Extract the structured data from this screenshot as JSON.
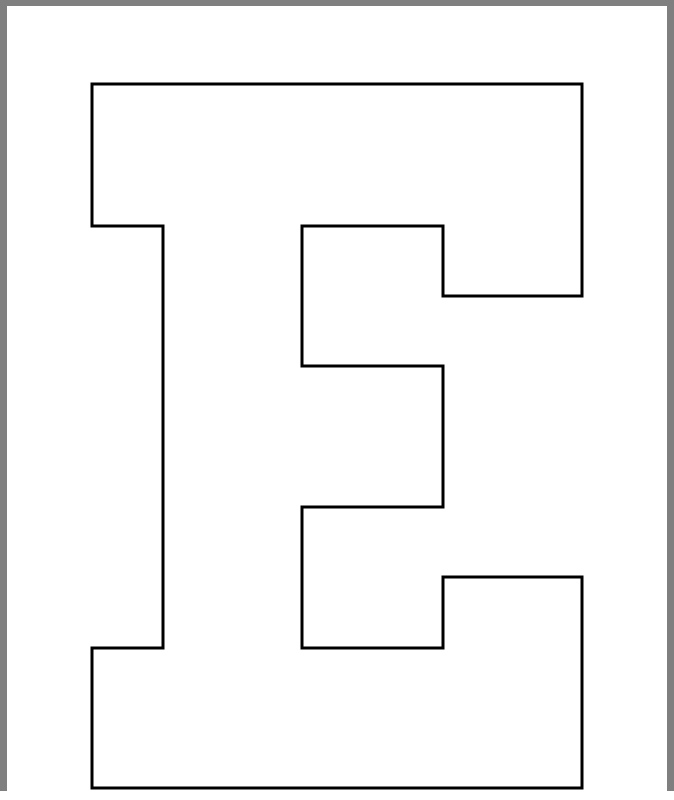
{
  "page": {
    "background_color": "#ffffff",
    "frame_color": "#7f7f7f"
  },
  "letter": {
    "character": "E",
    "outline_color": "#000000",
    "fill_color": "#ffffff",
    "stroke_width": 3,
    "outline_points": [
      [
        92,
        84
      ],
      [
        582,
        84
      ],
      [
        582,
        296
      ],
      [
        443,
        296
      ],
      [
        443,
        226
      ],
      [
        302,
        226
      ],
      [
        302,
        366
      ],
      [
        443,
        366
      ],
      [
        443,
        507
      ],
      [
        302,
        507
      ],
      [
        302,
        648
      ],
      [
        443,
        648
      ],
      [
        443,
        577
      ],
      [
        582,
        577
      ],
      [
        582,
        788
      ],
      [
        92,
        788
      ],
      [
        92,
        648
      ],
      [
        163,
        648
      ],
      [
        163,
        226
      ],
      [
        92,
        226
      ]
    ]
  }
}
